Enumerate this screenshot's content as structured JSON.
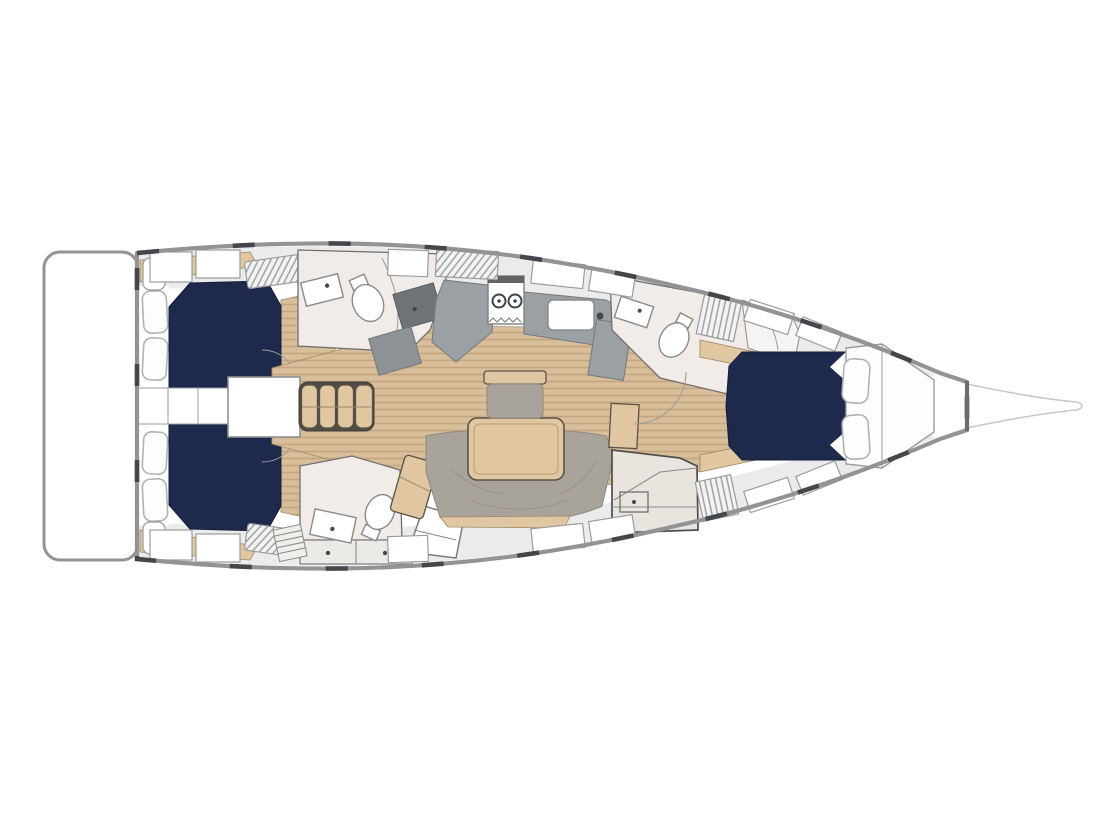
{
  "plan": {
    "aria_label": "Sailing yacht interior floor plan, top view, bow to the right",
    "regions": [
      {
        "id": "swim-platform",
        "label": "Swim platform"
      },
      {
        "id": "aft-cabin-port",
        "label": "Aft cabin port with double berth"
      },
      {
        "id": "aft-cabin-starboard",
        "label": "Aft cabin starboard with double berth"
      },
      {
        "id": "companionway-passage",
        "label": "Companionway passage"
      },
      {
        "id": "companionway-stairs",
        "label": "Companionway stairs"
      },
      {
        "id": "aft-head-port",
        "label": "Aft head port"
      },
      {
        "id": "aft-head-starboard",
        "label": "Aft head starboard"
      },
      {
        "id": "galley",
        "label": "Galley with stove and sink"
      },
      {
        "id": "salon",
        "label": "Salon with table and sofa"
      },
      {
        "id": "forward-head",
        "label": "Forward head"
      },
      {
        "id": "forward-cabin",
        "label": "Forward cabin with V-berth"
      },
      {
        "id": "anchor-locker",
        "label": "Anchor locker"
      },
      {
        "id": "bowsprit",
        "label": "Bowsprit"
      }
    ]
  },
  "colors": {
    "background": "#ffffff",
    "hull_outline": "#919395",
    "hull_dark_segment": "#43474c",
    "berth_navy": "#1e2a4c",
    "berth_navy_edge": "#141d38",
    "pillow_white": "#fdfdfd",
    "pillow_outline": "#b2b2b2",
    "wood_floor": "#d8be9b",
    "wood_floor_stripe": "#c5a67e",
    "wood_furniture": "#e0c6a1",
    "furniture_outline": "#5a5246",
    "counter_gray": "#9aa0a4",
    "counter_gray_mid": "#8d9296",
    "counter_gray_dark": "#6e7478",
    "upholstery_gray": "#a9a49b",
    "upholstery_line": "#8f897e",
    "head_floor": "#f2ece8",
    "deck_light": "#ebebeb",
    "locker_white": "#ffffff",
    "locker_outline": "#9b9b9b",
    "fixture_outline": "#8a8a8a",
    "thin_line": "#9a9a9a",
    "stair_dark": "#4f4b45"
  }
}
